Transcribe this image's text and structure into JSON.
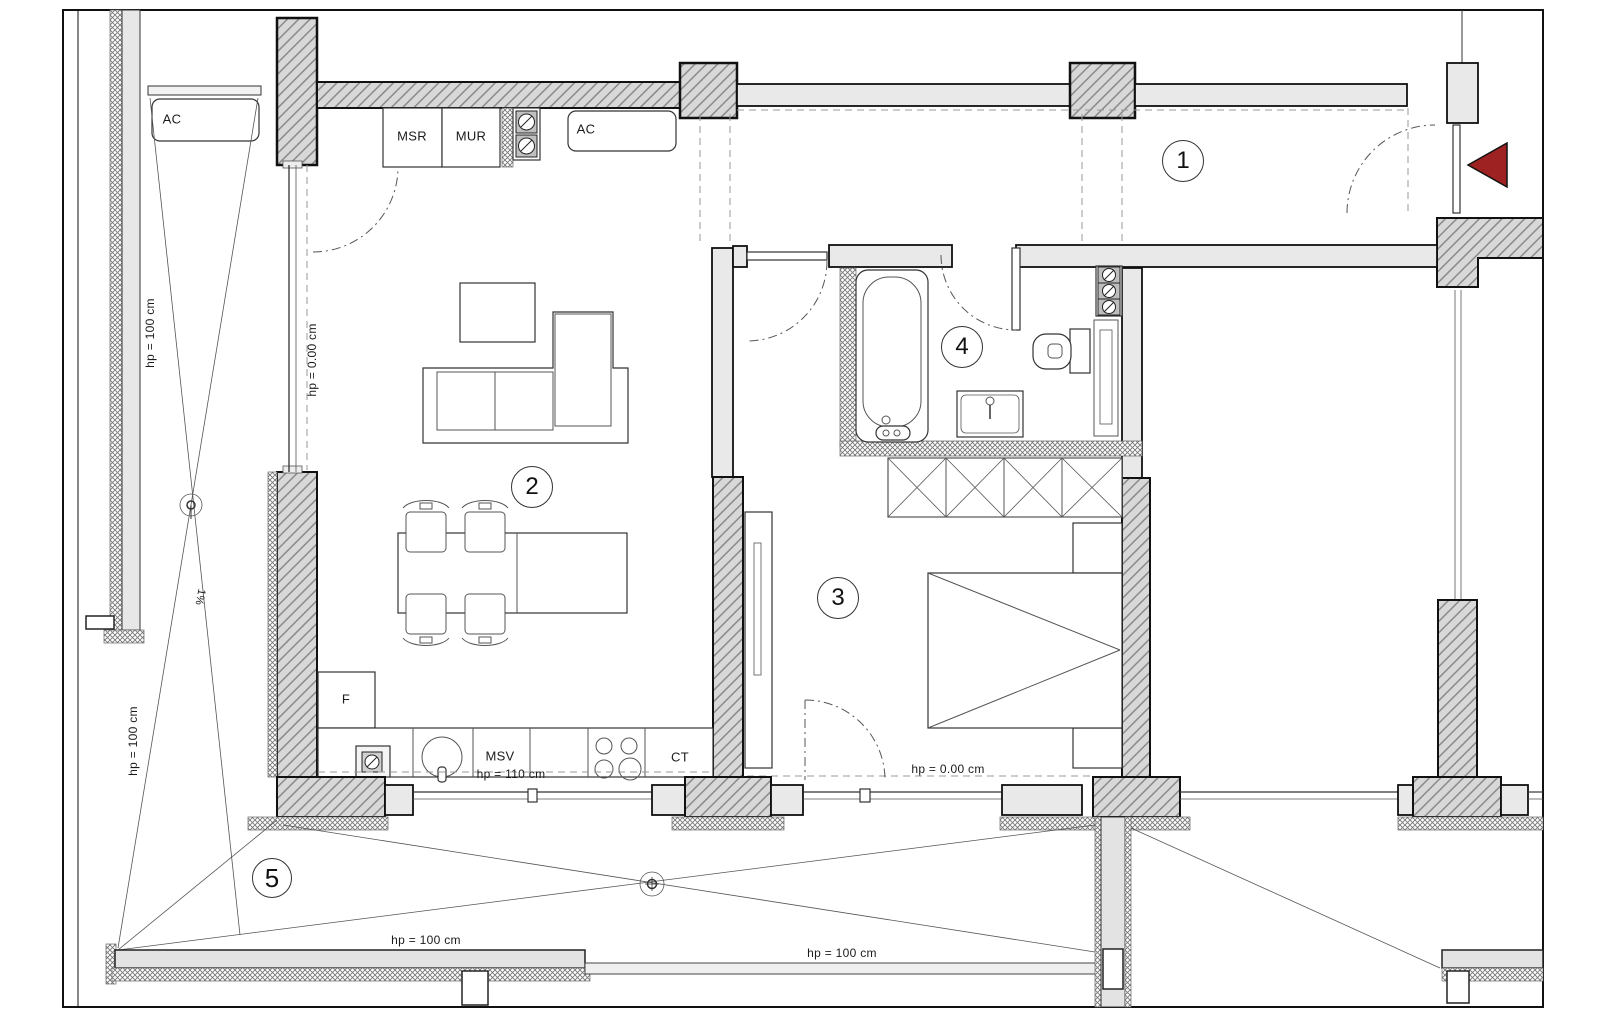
{
  "plan": {
    "rooms": [
      {
        "label": "1"
      },
      {
        "label": "2"
      },
      {
        "label": "3"
      },
      {
        "label": "4"
      },
      {
        "label": "5"
      }
    ],
    "labels": {
      "ac_balcony": "AC",
      "ac_hall": "AC",
      "msr": "MSR",
      "mur": "MUR",
      "fridge": "F",
      "msv": "MSV",
      "ct": "CT",
      "hp_counter": "hp = 110 cm",
      "hp_living": "hp = 0.00 cm",
      "hp_bedroom": "hp = 0.00 cm",
      "hp_balcony_upper": "hp = 100 cm",
      "hp_balcony_lower": "hp = 100 cm",
      "hp_terrace_left": "hp = 100 cm",
      "hp_terrace_right": "hp = 100 cm",
      "slope": "1%"
    },
    "colors": {
      "entry_arrow": "#9e2222",
      "wall_hatch_fill": "#d8d8d8",
      "wall_light_fill": "#e9e9e9",
      "line": "#1b1b1b"
    }
  }
}
